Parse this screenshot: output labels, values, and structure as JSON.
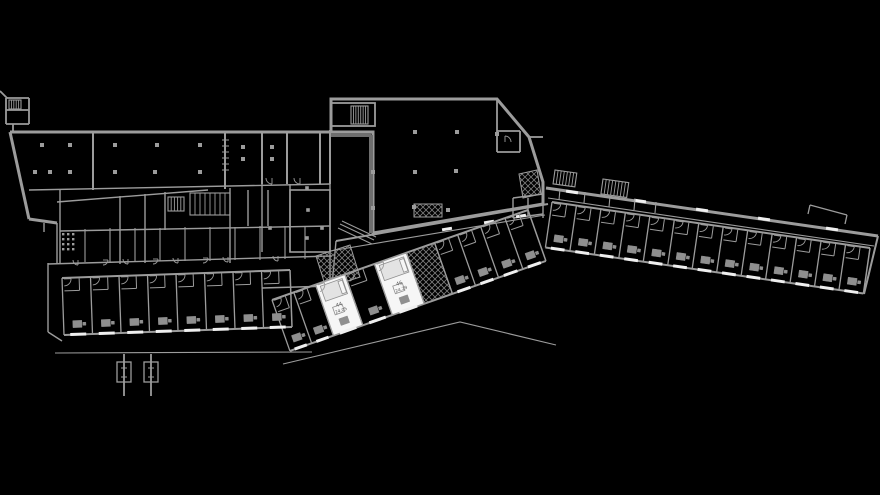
{
  "meta": {
    "drawing_type": "building-floor-plan",
    "background": "black"
  },
  "colors": {
    "bg": "#000000",
    "wall": "#9c9c9c",
    "wall_dim": "#6e6e6e",
    "window": "#efefef",
    "white_room": "#f6f6f6",
    "bed": "#e3e3e3",
    "furn": "#8f8f8f",
    "hatchline": "#7d7d7d",
    "text": "#5a5a5a"
  },
  "rooms_highlighted": [
    {
      "number": "44",
      "area": "24.05"
    },
    {
      "number": "46",
      "area": "24.29"
    }
  ],
  "floorplan": {
    "width": 880,
    "height": 495,
    "elements": [
      {
        "t": "mline",
        "name": "entry-block",
        "w": 1.8,
        "lines": [
          [
            6,
            98,
            29,
            98
          ],
          [
            6,
            98,
            6,
            124
          ],
          [
            6,
            124,
            29,
            124
          ],
          [
            29,
            98,
            29,
            124
          ],
          [
            6,
            110,
            29,
            110
          ],
          [
            13,
            124,
            13,
            132
          ],
          [
            0,
            91,
            7,
            98
          ]
        ]
      },
      {
        "t": "stair",
        "name": "entry-stair",
        "x": 9,
        "y": 100,
        "w": 12,
        "h": 9,
        "n": 4
      },
      {
        "t": "line",
        "name": "north-wall",
        "x1": 10,
        "y1": 132,
        "x2": 373,
        "y2": 132,
        "w": 3
      },
      {
        "t": "mline",
        "name": "west-diagonal-wall",
        "w": 3,
        "lines": [
          [
            10,
            132,
            29,
            219
          ],
          [
            29,
            219,
            57,
            223
          ]
        ]
      },
      {
        "t": "mline",
        "name": "west-wall-details",
        "w": 1.4,
        "lines": [
          [
            44,
            223,
            44,
            232
          ],
          [
            57,
            223,
            57,
            263
          ],
          [
            48,
            263,
            48,
            332
          ],
          [
            48,
            332,
            62,
            341
          ]
        ]
      },
      {
        "t": "line",
        "name": "left-band-floor",
        "x1": 29,
        "y1": 190,
        "x2": 330,
        "y2": 184,
        "w": 1.4
      },
      {
        "t": "mline",
        "name": "left-band-dividers",
        "w": 2,
        "lines": [
          [
            93,
            132,
            93,
            190
          ],
          [
            225,
            132,
            225,
            189
          ],
          [
            262,
            132,
            262,
            184
          ],
          [
            287,
            132,
            287,
            184
          ],
          [
            320,
            132,
            320,
            184
          ],
          [
            330,
            130,
            330,
            184
          ]
        ]
      },
      {
        "t": "mline",
        "name": "wall-hatch-ticks",
        "w": 1,
        "lines": [
          [
            222,
            140,
            229,
            140
          ],
          [
            222,
            146,
            229,
            146
          ],
          [
            222,
            152,
            229,
            152
          ],
          [
            222,
            158,
            229,
            158
          ],
          [
            222,
            164,
            229,
            164
          ],
          [
            222,
            170,
            229,
            170
          ]
        ]
      },
      {
        "t": "sq",
        "name": "columns-left-band",
        "s": 4,
        "pts": [
          [
            42,
            145
          ],
          [
            70,
            145
          ],
          [
            115,
            145
          ],
          [
            157,
            145
          ],
          [
            200,
            145
          ],
          [
            35,
            172
          ],
          [
            50,
            172
          ],
          [
            70,
            172
          ],
          [
            115,
            172
          ],
          [
            155,
            172
          ],
          [
            200,
            172
          ],
          [
            243,
            147
          ],
          [
            243,
            159
          ],
          [
            272,
            147
          ],
          [
            272,
            159
          ]
        ]
      },
      {
        "t": "arcs",
        "name": "left-band-doors",
        "r": 6,
        "list": [
          [
            272,
            178,
            90,
            180
          ],
          [
            300,
            178,
            90,
            180
          ]
        ]
      },
      {
        "t": "mline",
        "name": "cluster-walls",
        "w": 1.4,
        "lines": [
          [
            57,
            202,
            208,
            190
          ],
          [
            60,
            231,
            330,
            226
          ],
          [
            48,
            264,
            332,
            256
          ],
          [
            60,
            190,
            60,
            264
          ],
          [
            120,
            196,
            120,
            264
          ],
          [
            145,
            194,
            145,
            263
          ],
          [
            165,
            192,
            165,
            230
          ],
          [
            230,
            188,
            230,
            263
          ],
          [
            248,
            190,
            248,
            226
          ],
          [
            268,
            190,
            268,
            226
          ],
          [
            262,
            184,
            262,
            252
          ],
          [
            290,
            184,
            290,
            252
          ],
          [
            330,
            184,
            330,
            290
          ],
          [
            262,
            288,
            332,
            286
          ],
          [
            332,
            286,
            336,
            241
          ]
        ]
      },
      {
        "t": "mline",
        "name": "cluster-room-dividers",
        "w": 1.1,
        "lines": [
          [
            85,
            229,
            85,
            262
          ],
          [
            110,
            228,
            110,
            262
          ],
          [
            135,
            228,
            135,
            262
          ],
          [
            160,
            228,
            160,
            261
          ],
          [
            185,
            227,
            185,
            261
          ],
          [
            210,
            227,
            210,
            261
          ],
          [
            235,
            227,
            235,
            260
          ],
          [
            260,
            226,
            260,
            260
          ],
          [
            285,
            226,
            285,
            259
          ],
          [
            305,
            226,
            305,
            259
          ]
        ]
      },
      {
        "t": "arcs",
        "name": "cluster-doors",
        "r": 5,
        "list": [
          [
            78,
            260,
            90,
            180
          ],
          [
            128,
            259,
            90,
            180
          ],
          [
            178,
            258,
            90,
            180
          ],
          [
            228,
            257,
            90,
            180
          ],
          [
            278,
            256,
            90,
            180
          ],
          [
            103,
            260,
            0,
            90
          ],
          [
            153,
            259,
            0,
            90
          ],
          [
            203,
            258,
            0,
            90
          ]
        ]
      },
      {
        "t": "stair",
        "name": "service-bars-1",
        "x": 190,
        "y": 193,
        "w": 40,
        "h": 22,
        "n": 7
      },
      {
        "t": "stair",
        "name": "service-bars-2",
        "x": 168,
        "y": 197,
        "w": 16,
        "h": 14,
        "n": 4
      },
      {
        "t": "dots",
        "name": "shaft-grid",
        "x": 62,
        "y": 233,
        "cols": 3,
        "rows": 4,
        "pitch": 5,
        "s": 2.4
      },
      {
        "t": "rect",
        "name": "mid-big-room",
        "x": 290,
        "y": 190,
        "w": 40,
        "h": 62,
        "sw": 1.6
      },
      {
        "t": "sq",
        "name": "columns-mid-room",
        "s": 3.6,
        "pts": [
          [
            307,
            188
          ],
          [
            308,
            210
          ],
          [
            307,
            238
          ],
          [
            322,
            228
          ],
          [
            270,
            228
          ]
        ]
      },
      {
        "t": "hatch",
        "name": "stairwell-junction",
        "pts": [
          [
            316,
            256
          ],
          [
            350,
            245
          ],
          [
            360,
            277
          ],
          [
            326,
            288
          ]
        ]
      },
      {
        "t": "poly",
        "name": "hall-outline",
        "w": 3,
        "pts": [
          [
            331,
            99
          ],
          [
            497,
            99
          ],
          [
            529,
            137
          ],
          [
            543,
            182
          ],
          [
            543,
            204
          ],
          [
            373,
            233
          ],
          [
            373,
            132
          ],
          [
            331,
            132
          ]
        ]
      },
      {
        "t": "mline",
        "name": "hall-inner-dark",
        "w": 4,
        "c": "wall_dim",
        "lines": [
          [
            331,
            135,
            371,
            135
          ],
          [
            371,
            135,
            371,
            233
          ]
        ]
      },
      {
        "t": "rect",
        "name": "hall-stair-block",
        "x": 331,
        "y": 103,
        "w": 44,
        "h": 23,
        "sw": 1.8
      },
      {
        "t": "stair",
        "name": "hall-stair",
        "x": 351,
        "y": 106,
        "w": 17,
        "h": 18,
        "n": 6
      },
      {
        "t": "hatch",
        "name": "hall-hatch",
        "pts": [
          [
            414,
            204
          ],
          [
            442,
            204
          ],
          [
            442,
            217
          ],
          [
            414,
            217
          ]
        ]
      },
      {
        "t": "sq",
        "name": "hall-columns",
        "s": 4,
        "pts": [
          [
            415,
            132
          ],
          [
            457,
            132
          ],
          [
            373,
            172
          ],
          [
            415,
            172
          ],
          [
            456,
            171
          ],
          [
            373,
            208
          ],
          [
            414,
            207
          ],
          [
            448,
            210
          ],
          [
            497,
            134
          ]
        ]
      },
      {
        "t": "mline",
        "name": "hall-annex",
        "w": 1.8,
        "lines": [
          [
            497,
            99,
            497,
            131
          ],
          [
            497,
            131,
            520,
            131
          ],
          [
            520,
            131,
            520,
            152
          ],
          [
            497,
            152,
            520,
            152
          ],
          [
            497,
            131,
            497,
            152
          ],
          [
            529,
            137,
            543,
            137
          ]
        ]
      },
      {
        "t": "hatch",
        "name": "annex-hatch",
        "pts": [
          [
            519,
            174
          ],
          [
            537,
            170
          ],
          [
            541,
            194
          ],
          [
            523,
            198
          ]
        ]
      },
      {
        "t": "mline",
        "name": "annex-rooms",
        "w": 1.4,
        "lines": [
          [
            513,
            198,
            543,
            194
          ],
          [
            513,
            198,
            513,
            218
          ],
          [
            513,
            218,
            543,
            214
          ],
          [
            543,
            194,
            543,
            218
          ],
          [
            528,
            198,
            528,
            216
          ]
        ]
      },
      {
        "t": "arcs",
        "name": "annex-door",
        "r": 6,
        "list": [
          [
            505,
            142,
            270,
            360
          ]
        ]
      },
      {
        "t": "mline",
        "name": "upper-corridor",
        "w": 2,
        "lines": [
          [
            336,
            241,
            548,
            204
          ]
        ]
      },
      {
        "t": "mline",
        "name": "upper-corridor-inner",
        "w": 1.1,
        "lines": [
          [
            330,
            251,
            545,
            215
          ]
        ]
      },
      {
        "t": "dash",
        "name": "corridor-windows",
        "len": 10,
        "ang": -9.5,
        "pts": [
          [
            447,
            229
          ],
          [
            489,
            222
          ],
          [
            521,
            216
          ]
        ]
      },
      {
        "t": "mline",
        "name": "ramp",
        "w": 1,
        "lines": [
          [
            338,
            228,
            372,
            244
          ],
          [
            340,
            224,
            374,
            240
          ],
          [
            342,
            221,
            376,
            237
          ]
        ]
      },
      {
        "t": "wing",
        "name": "mid-wing",
        "a": [
          272,
          300
        ],
        "b": [
          528,
          210
        ],
        "d": 54,
        "ws": [
          0.085,
          0.085,
          0.115,
          0.115,
          0.125,
          0.11,
          0.09,
          0.09,
          0.095,
          0.09
        ],
        "kinds": [
          "room",
          "room",
          "white",
          "room",
          "white",
          "hatch",
          "room",
          "room",
          "room",
          "room"
        ],
        "refs": {
          "2": 0,
          "4": 1
        }
      },
      {
        "t": "pline",
        "name": "terrace-edge",
        "w": 1.1,
        "pts": [
          [
            283,
            364
          ],
          [
            460,
            322
          ],
          [
            556,
            345
          ]
        ]
      },
      {
        "t": "line",
        "name": "east-wing-wall",
        "x1": 546,
        "y1": 188,
        "x2": 878,
        "y2": 236,
        "w": 3
      },
      {
        "t": "dash",
        "name": "east-wall-windows",
        "len": 12,
        "ang": 8.2,
        "pts": [
          [
            572,
            192
          ],
          [
            640,
            201
          ],
          [
            702,
            210
          ],
          [
            764,
            219
          ],
          [
            832,
            229
          ]
        ]
      },
      {
        "t": "line",
        "name": "east-corridor",
        "x1": 548,
        "y1": 198,
        "x2": 874,
        "y2": 246,
        "w": 1.1
      },
      {
        "t": "wing",
        "name": "east-wing",
        "a": [
          552,
          202
        ],
        "b": [
          870,
          248
        ],
        "d": 46,
        "n": 13
      },
      {
        "t": "mline",
        "name": "east-end-cap",
        "w": 2,
        "lines": [
          [
            878,
            236,
            864,
            294
          ]
        ]
      },
      {
        "t": "mline",
        "name": "east-upper-dividers",
        "w": 1.1,
        "lines": [
          [
            560,
            189,
            559,
            200
          ],
          [
            585,
            192,
            584,
            203
          ],
          [
            610,
            196,
            609,
            207
          ],
          [
            635,
            199,
            634,
            210
          ],
          [
            656,
            202,
            655,
            213
          ]
        ]
      },
      {
        "t": "stair",
        "name": "stair-block-1",
        "x": 555,
        "y": 170,
        "w": 22,
        "h": 14,
        "n": 6,
        "rot": 8
      },
      {
        "t": "stair",
        "name": "stair-block-2",
        "x": 603,
        "y": 179,
        "w": 26,
        "h": 15,
        "n": 7,
        "rot": 8
      },
      {
        "t": "mline",
        "name": "canopy-stub",
        "w": 1.3,
        "lines": [
          [
            808,
            214,
            810,
            205
          ],
          [
            810,
            205,
            847,
            215
          ],
          [
            847,
            215,
            845,
            224
          ]
        ]
      },
      {
        "t": "wing",
        "name": "south-wing",
        "a": [
          62,
          278
        ],
        "b": [
          290,
          270
        ],
        "d": 57,
        "n": 8
      },
      {
        "t": "line",
        "name": "south-parapet",
        "x1": 55,
        "y1": 353,
        "x2": 312,
        "y2": 352,
        "w": 1.1
      },
      {
        "t": "pole",
        "name": "flagpole-1",
        "x": 117
      },
      {
        "t": "pole",
        "name": "flagpole-2",
        "x": 144
      }
    ]
  }
}
